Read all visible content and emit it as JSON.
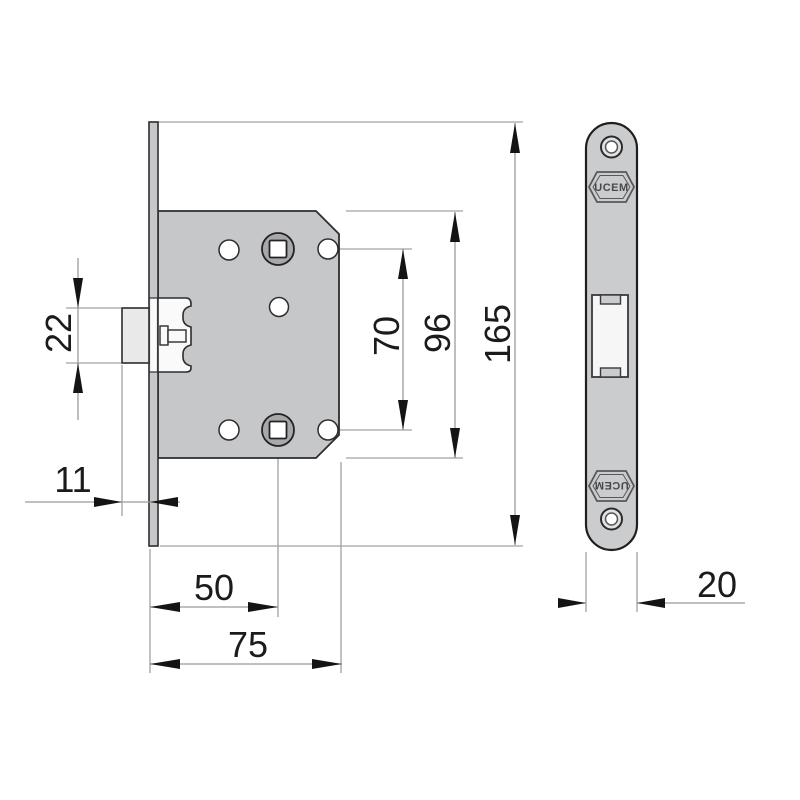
{
  "drawing": {
    "brand": "UCEM",
    "dimensions": {
      "latch_bolt_height": "22",
      "faceplate_to_latch_front": "11",
      "backset": "50",
      "body_depth": "75",
      "square_holes_distance": "70",
      "body_height": "96",
      "faceplate_height": "165",
      "faceplate_width": "20"
    },
    "colors": {
      "background": "#ffffff",
      "body_fill": "#c6c7c9",
      "faceplate_fill": "#cbcccd",
      "latch_front_fill": "#e9e9ea",
      "spindle_ring_fill": "#a8a8aa",
      "hole_fill": "#ffffff",
      "outline": "#2d2d2f",
      "dimension_line": "#a2a2a2",
      "dimension_text": "#1b1b1b"
    }
  }
}
